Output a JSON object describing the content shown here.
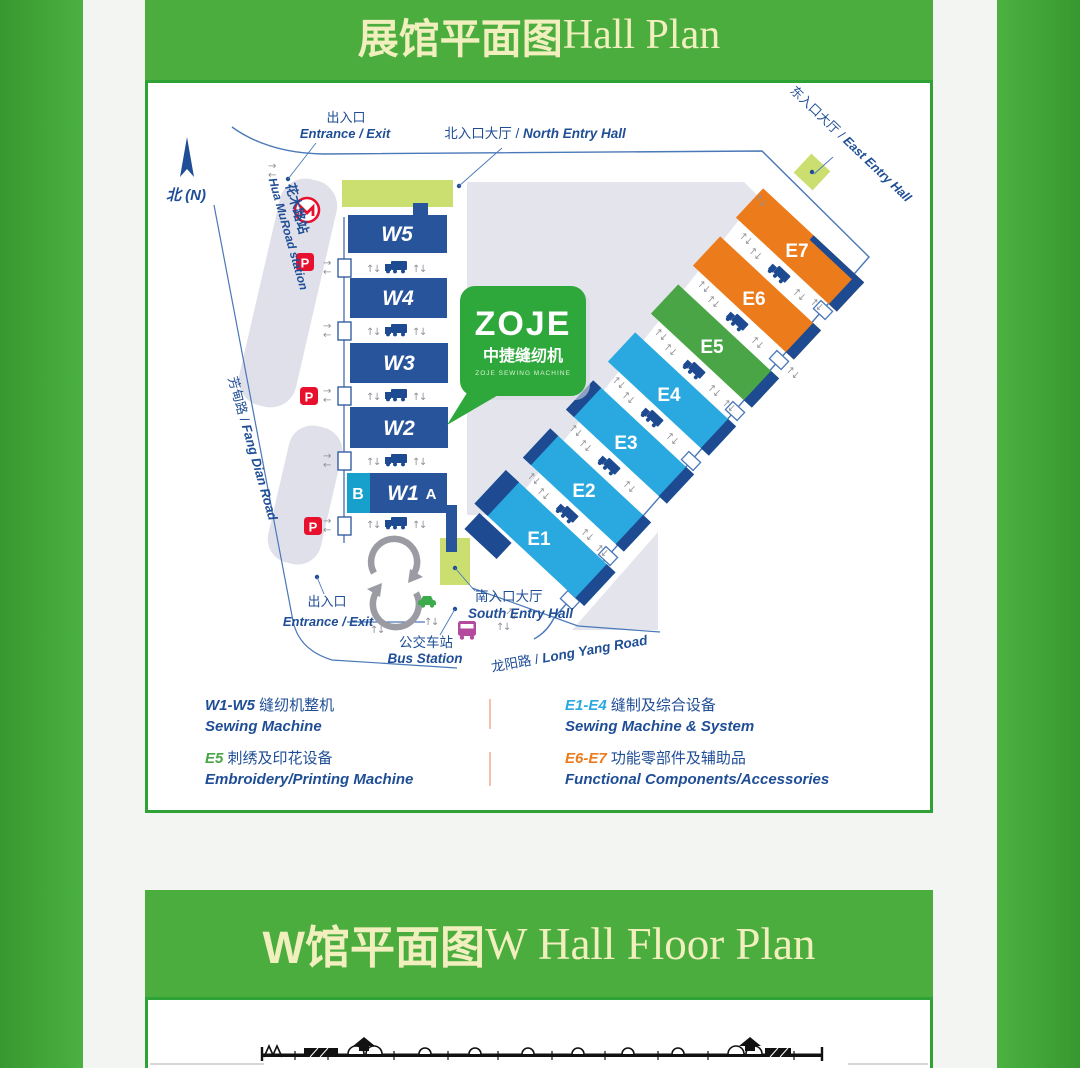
{
  "theme": {
    "band_green": "#4bad3e",
    "card_border_green": "#2fa236",
    "title_yellow": "#f1efbd",
    "map_text_navy": "#1f4e96",
    "hall_navy": "#27549b",
    "hall_cyan": "#18a0cd",
    "hall_blue": "#29a9e0",
    "hall_green": "#4aa547",
    "hall_orange": "#ec7b1c",
    "entry_green": "#cbdf70",
    "yard_gray": "#e4e4ed",
    "road_gray": "#e0e0ea",
    "boundary_blue": "#4a78b8",
    "parking_red": "#e8112d",
    "zoje_green": "#2ea83b",
    "arrow_gray": "#8f8f98",
    "car_green": "#3cab49",
    "bus_magenta": "#b44a9e"
  },
  "band1": {
    "zh": "展馆平面图",
    "en": " Hall Plan"
  },
  "band2": {
    "zh": "W馆平面图",
    "en": " W Hall Floor Plan"
  },
  "map": {
    "north": "北 (N)",
    "entrance_top_zh": "出入口",
    "entrance_top_en": "Entrance / Exit",
    "north_entry_zh": "北入口大厅 / ",
    "north_entry_en": "North Entry Hall",
    "east_entry_zh": "东入口大厅 / ",
    "east_entry_en": "East Entry Hall",
    "station_zh": "花木路站",
    "station_en": "Hua MuRoad station",
    "fangdian_zh": "芳甸路 / ",
    "fangdian_en": "Fang Dian Road",
    "longyang_zh": "龙阳路 / ",
    "longyang_en": "Long Yang Road",
    "south_entry_zh": "南入口大厅",
    "south_entry_en": "South Entry Hall",
    "bus_zh": "公交车站",
    "bus_en": "Bus Station",
    "entrance_bottom_zh": "出入口",
    "entrance_bottom_en": "Entrance / Exit",
    "parking": "P",
    "w_halls": [
      "W5",
      "W4",
      "W3",
      "W2"
    ],
    "w1": {
      "b": "B",
      "label": "W1",
      "a": "A"
    },
    "e_halls": [
      {
        "id": "E1",
        "color": "#29a9e0"
      },
      {
        "id": "E2",
        "color": "#29a9e0"
      },
      {
        "id": "E3",
        "color": "#29a9e0"
      },
      {
        "id": "E4",
        "color": "#29a9e0"
      },
      {
        "id": "E5",
        "color": "#4aa547"
      },
      {
        "id": "E6",
        "color": "#ec7b1c"
      },
      {
        "id": "E7",
        "color": "#ec7b1c"
      }
    ],
    "zoje": {
      "wordmark": "ZOJE",
      "zh": "中捷缝纫机",
      "sub": "ZOJE SEWING MACHINE"
    }
  },
  "legend": {
    "items": [
      {
        "code": "W1-W5",
        "zh": " 缝纫机整机",
        "en": "Sewing Machine",
        "color": "#1f4e96"
      },
      {
        "code": "E1-E4",
        "zh": " 缝制及综合设备",
        "en": "Sewing Machine  & System",
        "color": "#29a9e0"
      },
      {
        "code": "E5",
        "zh": " 刺绣及印花设备",
        "en": "Embroidery/Printing Machine",
        "color": "#4aa547"
      },
      {
        "code": "E6-E7",
        "zh": " 功能零部件及辅助品",
        "en": "Functional Components/Accessories",
        "color": "#ec7b1c"
      }
    ]
  }
}
